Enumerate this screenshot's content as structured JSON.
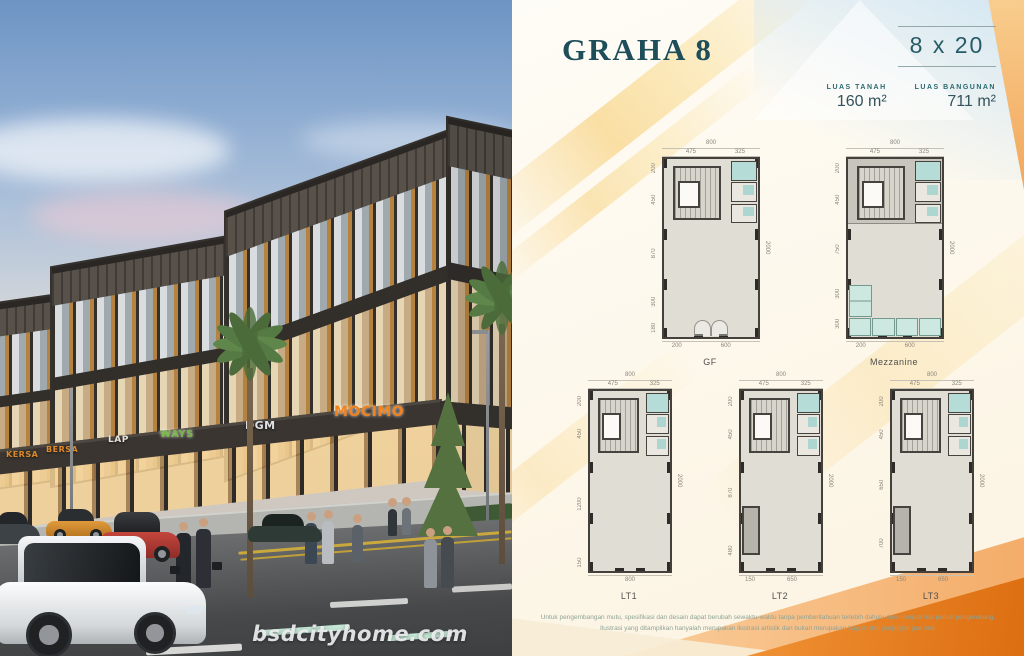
{
  "colors": {
    "accent_teal": "#1d4e5a",
    "accent_orange": "#e87a1f",
    "band_yellow": "#f6c85c",
    "plan_floor": "#e0ddd4",
    "plan_fixture": "#aed6d0"
  },
  "brochure": {
    "title": "GRAHA 8",
    "size_label": "8 x 20",
    "specs": [
      {
        "label": "LUAS TANAH",
        "value": "160 m²"
      },
      {
        "label": "LUAS BANGUNAN",
        "value": "711 m²"
      }
    ],
    "disclaimer_line1": "Untuk pengembangan mutu, spesifikasi dan desain dapat berubah sewaktu-waktu tanpa pemberitahuan terlebih dahulu dan menjadi hak penuh pengembang.",
    "disclaimer_line2": "Ilustrasi yang ditampilkan hanyalah merupakan ilustrasi artistik dan bukan merupakan bagian dari perjanjian jual beli."
  },
  "photo": {
    "watermark": "bsdcityhome.com",
    "signs": [
      {
        "label": "KERSA",
        "x": 6,
        "y": 450,
        "size": 8,
        "color": "#d98a2b",
        "glow": false
      },
      {
        "label": "BERSA",
        "x": 46,
        "y": 445,
        "size": 8,
        "color": "#e08a28",
        "glow": false
      },
      {
        "label": "LAP",
        "x": 108,
        "y": 435,
        "size": 9,
        "color": "#e8e4da",
        "glow": false
      },
      {
        "label": "WAYS",
        "x": 160,
        "y": 429,
        "size": 10,
        "color": "#7ab648",
        "glow": true
      },
      {
        "label": "DGM",
        "x": 245,
        "y": 419,
        "size": 11,
        "color": "#dfe2e4",
        "glow": false
      },
      {
        "label": "MOCIMO",
        "x": 334,
        "y": 404,
        "size": 14,
        "color": "#f0831e",
        "glow": true
      }
    ]
  },
  "plans": [
    {
      "variant": "gf",
      "caption": "GF",
      "top_total": "800",
      "top_segs": [
        "475",
        "325"
      ],
      "left_dims": [
        "200",
        "450",
        "870",
        "300",
        "180"
      ],
      "right_dim": "2000",
      "bottom_dims": [
        "200",
        "600"
      ]
    },
    {
      "variant": "mezz",
      "caption": "Mezzanine",
      "top_total": "800",
      "top_segs": [
        "475",
        "325"
      ],
      "left_dims": [
        "200",
        "450",
        "750",
        "300",
        "300"
      ],
      "right_dim": "2000",
      "bottom_dims": [
        "200",
        "600"
      ]
    },
    {
      "variant": "lt1",
      "caption": "LT1",
      "top_total": "800",
      "top_segs": [
        "475",
        "325"
      ],
      "left_dims": [
        "200",
        "450",
        "1200",
        "150"
      ],
      "right_dim": "2000",
      "bottom_dims": [
        "800"
      ]
    },
    {
      "variant": "lt2",
      "caption": "LT2",
      "top_total": "800",
      "top_segs": [
        "475",
        "325"
      ],
      "left_dims": [
        "200",
        "450",
        "870",
        "480"
      ],
      "right_dim": "2000",
      "bottom_dims": [
        "150",
        "650"
      ]
    },
    {
      "variant": "lt3",
      "caption": "LT3",
      "top_total": "800",
      "top_segs": [
        "475",
        "325"
      ],
      "left_dims": [
        "200",
        "450",
        "650",
        "700"
      ],
      "right_dim": "2000",
      "bottom_dims": [
        "150",
        "650"
      ]
    }
  ]
}
